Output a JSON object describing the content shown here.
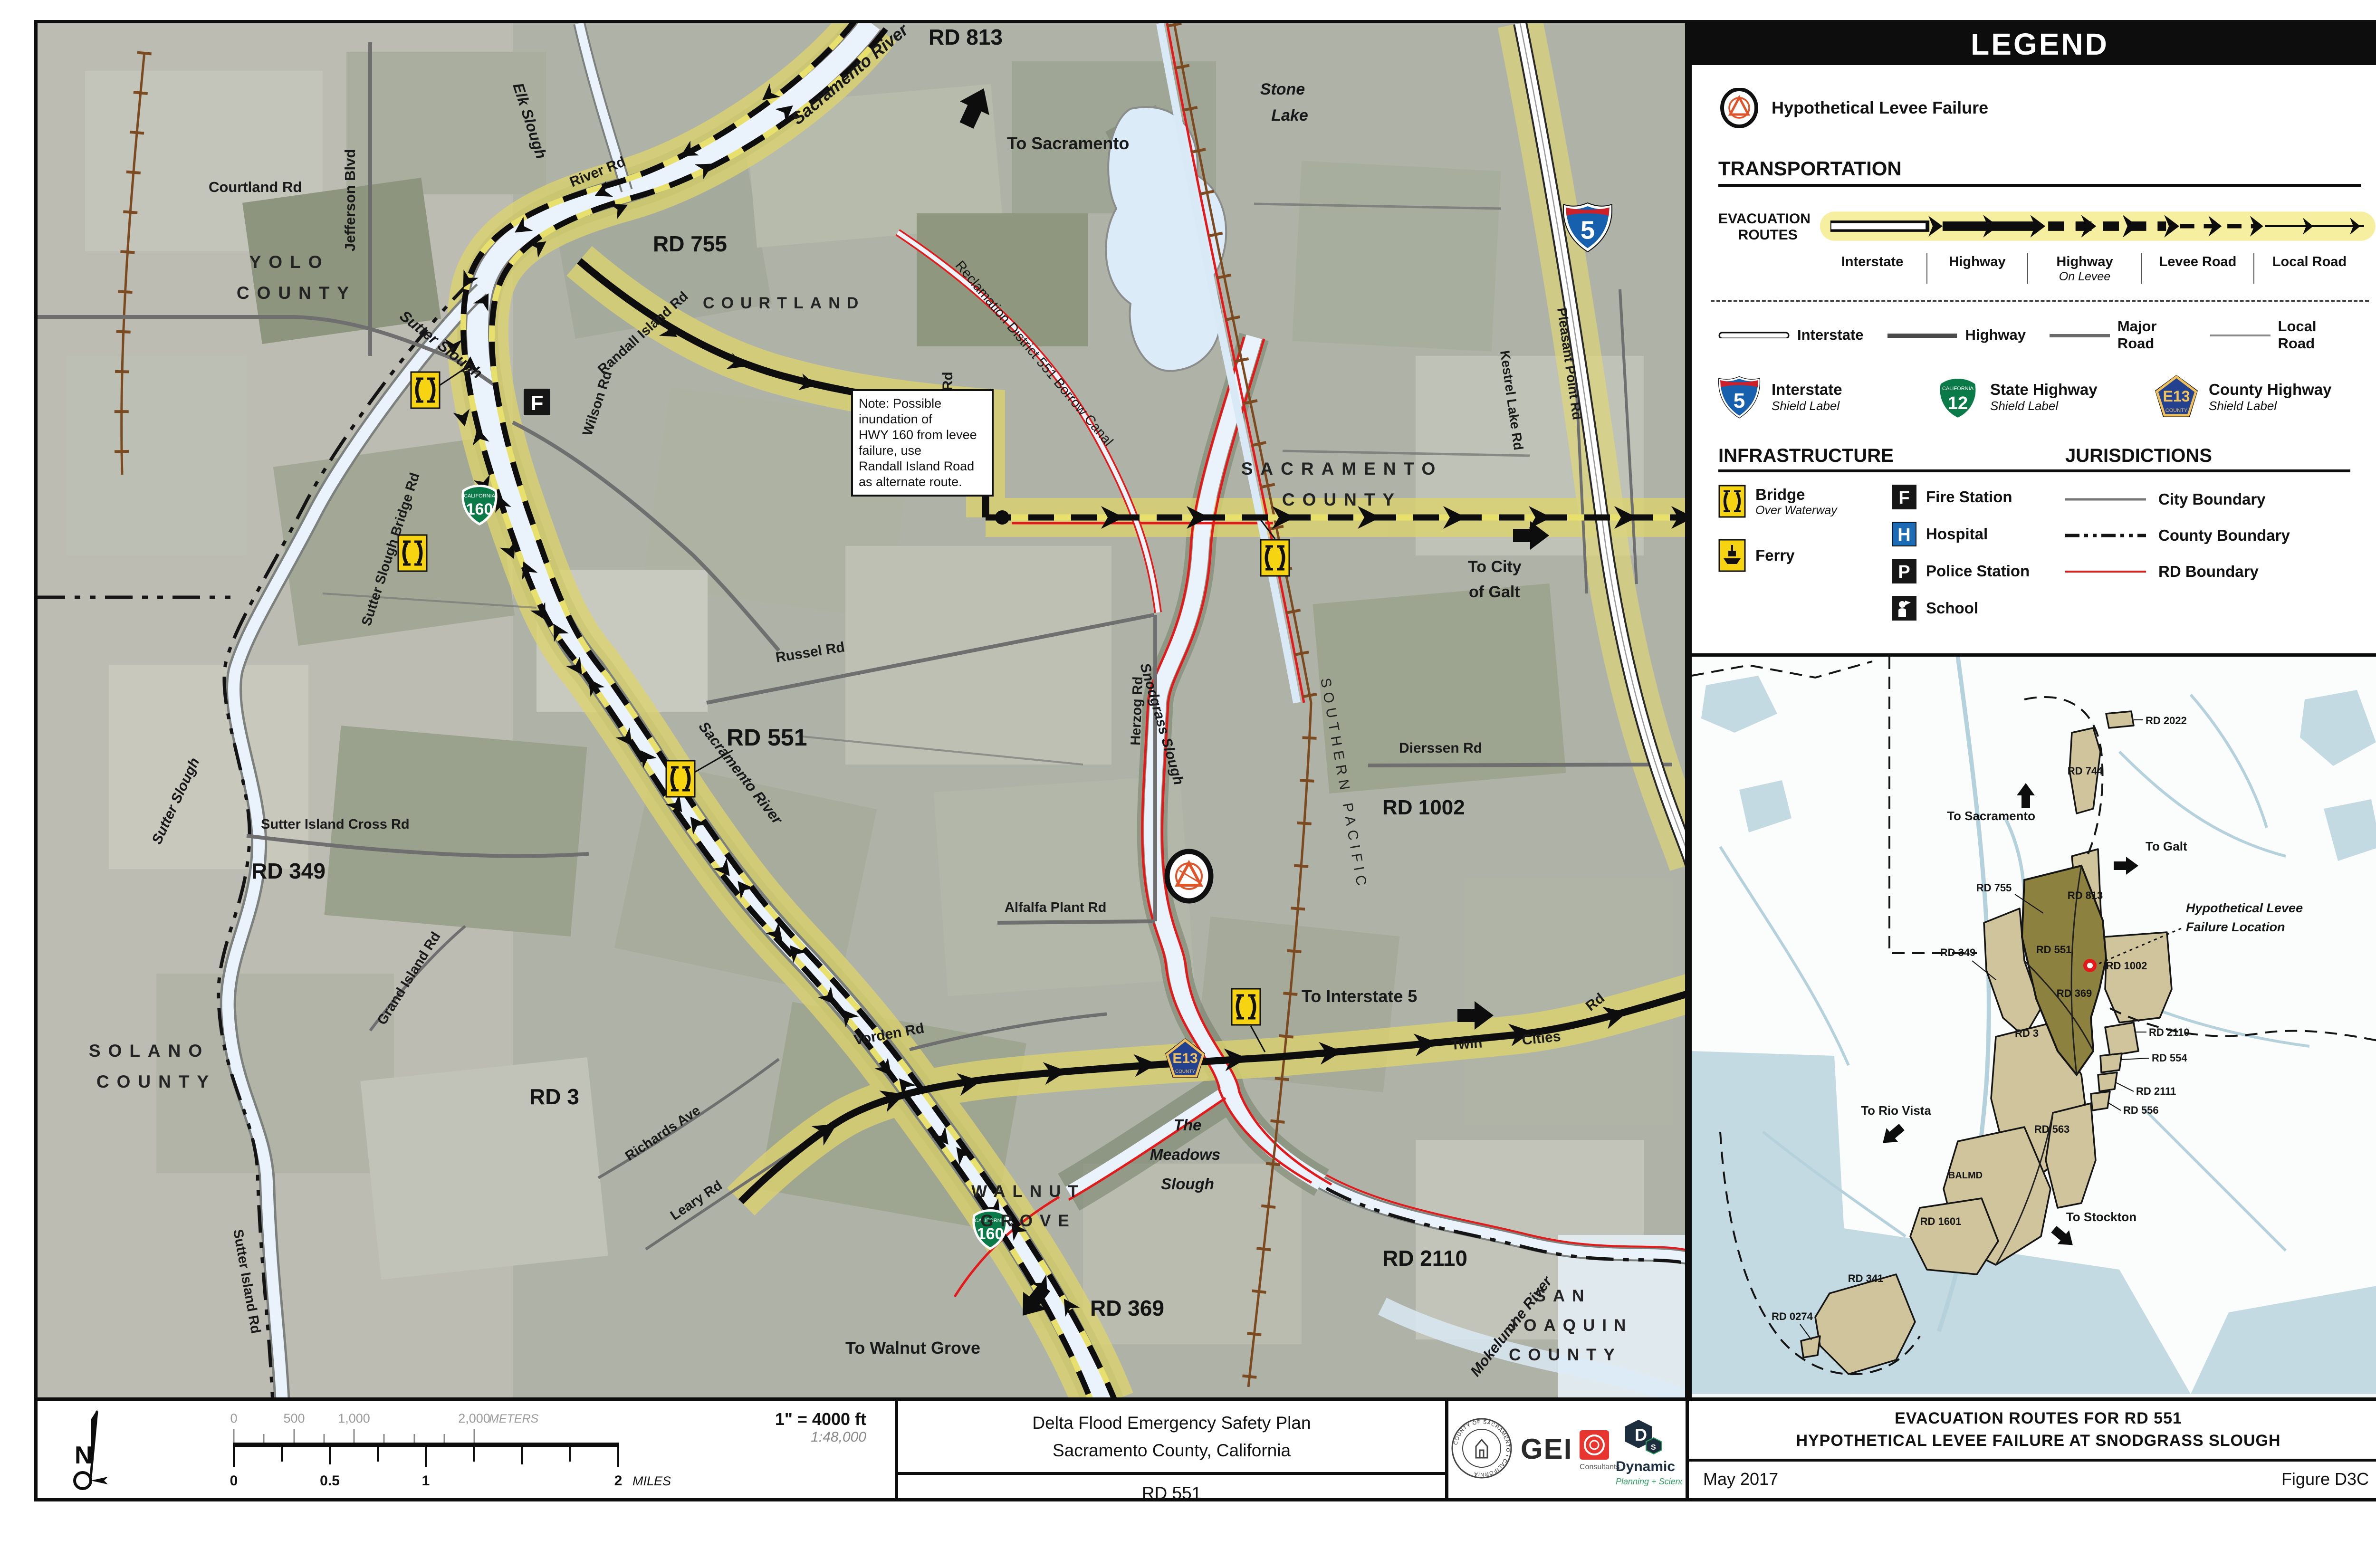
{
  "legend": {
    "title": "LEGEND",
    "failure_label": "Hypothetical Levee Failure",
    "transportation": {
      "heading": "TRANSPORTATION",
      "evac_label_1": "EVACUATION",
      "evac_label_2": "ROUTES",
      "route_labels": [
        {
          "label": "Interstate",
          "sub": ""
        },
        {
          "label": "Highway",
          "sub": ""
        },
        {
          "label": "Highway",
          "sub": "On Levee"
        },
        {
          "label": "Levee Road",
          "sub": ""
        },
        {
          "label": "Local Road",
          "sub": ""
        }
      ],
      "road_classes": [
        {
          "label": "Interstate"
        },
        {
          "label": "Highway"
        },
        {
          "label": "Major Road"
        },
        {
          "label": "Local Road"
        }
      ],
      "shields": [
        {
          "number": "5",
          "top": "",
          "label": "Interstate",
          "sub": "Shield Label"
        },
        {
          "number": "12",
          "top": "CALIFORNIA",
          "label": "State Highway",
          "sub": "Shield Label"
        },
        {
          "number": "E13",
          "top": "COUNTY",
          "label": "County Highway",
          "sub": "Shield Label"
        }
      ]
    },
    "infrastructure": {
      "heading": "INFRASTRUCTURE",
      "bridge": {
        "label": "Bridge",
        "sub": "Over Waterway"
      },
      "ferry": {
        "label": "Ferry"
      },
      "fire": {
        "icon": "F",
        "label": "Fire Station"
      },
      "hospital": {
        "icon": "H",
        "label": "Hospital"
      },
      "police": {
        "icon": "P",
        "label": "Police Station"
      },
      "school": {
        "label": "School"
      }
    },
    "jurisdictions": {
      "heading": "JURISDICTIONS",
      "items": [
        {
          "label": "City Boundary"
        },
        {
          "label": "County Boundary"
        },
        {
          "label": "RD Boundary"
        }
      ]
    },
    "colors": {
      "highlight": "#f6ef9f",
      "rd_boundary": "#e31a1c",
      "hospital_blue": "#1c6bb5"
    }
  },
  "map": {
    "icons": {
      "fire": "F"
    },
    "shields": {
      "i5": "5",
      "ca160": "160",
      "e13": "E13",
      "county": "COUNTY",
      "california": "CALIFORNIA"
    },
    "note": "Note: Possible\ninundation of\nHWY 160 from levee\nfailure, use\nRandall Island Road\nas alternate route.",
    "labels": {
      "courtland_rd": "Courtland   Rd",
      "jefferson_blvd": "Jefferson      Blvd",
      "yolo_1": "YOLO",
      "yolo_2": "COUNTY",
      "elk_slough": "Elk Slough",
      "sutter_slough": "Sutter Slough",
      "sutter_slough_bridge_rd": "Sutter Slough Bridge Rd",
      "sacramento_river": "Sacramento River",
      "river_rd": "River    Rd",
      "randall_island_rd": "Randall  Island   Rd",
      "rd_813": "RD 813",
      "rd_755": "RD 755",
      "courtland_town": "COURTLAND",
      "to_sacramento": "To Sacramento",
      "reclamation_canal": "Reclamation District 551 Borrow Canal",
      "wilson_rd": "Wilson    Rd",
      "lambert_rd": "Lambert      Rd",
      "stone_1": "Stone",
      "stone_2": "Lake",
      "sacramento_cnty_1": "SACRAMENTO",
      "sacramento_cnty_2": "COUNTY",
      "to_city_of_galt_1": "To City",
      "to_city_of_galt_2": "of Galt",
      "kestrel_lake_rd": "Kestrel   Lake   Rd",
      "pleasant_point_rd": "Pleasant   Point   Rd",
      "dierssen_rd": "Dierssen    Rd",
      "rd_1002": "RD 1002",
      "russel_rd": "Russel    Rd",
      "rd_551": "RD 551",
      "herzog_rd": "Herzog   Rd",
      "alfalfa_plant_rd": "Alfalfa     Plant     Rd",
      "southern_pacific": "SOUTHERN  PACIFIC",
      "snodgrass_slough": "Snodgrass Slough",
      "sutter_island_cross_rd": "Sutter     Island     Cross     Rd",
      "rd_349": "RD 349",
      "solano_1": "SOLANO",
      "solano_2": "COUNTY",
      "sutter_island_rd": "Sutter   Island   Rd",
      "grand_island_rd": "Grand   Island   Rd",
      "rd_3": "RD 3",
      "vorden_rd": "Vorden    Rd",
      "richards_ave": "Richards   Ave",
      "leary_rd": "Leary    Rd",
      "to_interstate_5": "To Interstate 5",
      "twin": "Twin",
      "cities": "Cities",
      "twin_rd": "Rd",
      "meadows_1": "The",
      "meadows_2": "Meadows",
      "meadows_3": "Slough",
      "walnut_1": "WALNUT",
      "walnut_2": "GROVE",
      "to_walnut_grove": "To Walnut Grove",
      "rd_369": "RD 369",
      "rd_2110": "RD 2110",
      "mokelumne_river": "Mokelumne River",
      "sanjoaquin_1": "SAN",
      "sanjoaquin_2": "JOAQUIN",
      "sanjoaquin_3": "COUNTY"
    }
  },
  "inset": {
    "labels": {
      "rd_2022": "RD 2022",
      "rd_744": "RD 744",
      "to_sacramento": "To Sacramento",
      "to_galt": "To Galt",
      "rd_755": "RD 755",
      "rd_813": "RD 813",
      "rd_349": "RD 349",
      "rd_551": "RD 551",
      "rd_1002": "RD 1002",
      "rd_369": "RD 369",
      "rd_3": "RD 3",
      "rd_2110": "RD 2110",
      "rd_554": "RD 554",
      "rd_2111": "RD 2111",
      "rd_556": "RD 556",
      "rd_563": "RD 563",
      "balmd": "BALMD",
      "rd_1601": "RD 1601",
      "rd_341": "RD 341",
      "rd_0274": "RD 0274",
      "to_rio_vista": "To Rio Vista",
      "to_stockton": "To Stockton"
    },
    "failure_line1": "Hypothetical Levee",
    "failure_line2": "Failure Location"
  },
  "footer": {
    "scale_in": "1\" = 4000 ft",
    "scale_ratio": "1:48,000",
    "north": "N",
    "meters": {
      "t0": "0",
      "t500": "500",
      "t1000": "1,000",
      "t2000": "2,000",
      "unit": "METERS"
    },
    "miles": {
      "t0": "0",
      "t05": "0.5",
      "t1": "1",
      "t2": "2",
      "unit": "MILES"
    },
    "plan_line1": "Delta Flood Emergency Safety Plan",
    "plan_line2": "Sacramento County, California",
    "sheet": "RD 551",
    "logos": {
      "seal_text": "COUNTY OF SACRAMENTO  •  CALIFORNIA",
      "gei": "GEI",
      "gei_sub": "Consultants",
      "dynamic": "Dynamic",
      "dynamic_sub": "Planning + Science"
    },
    "title_line1": "EVACUATION ROUTES FOR RD 551",
    "title_line2": "HYPOTHETICAL LEVEE FAILURE AT SNODGRASS SLOUGH",
    "date": "May 2017",
    "figure": "Figure  D3C"
  }
}
